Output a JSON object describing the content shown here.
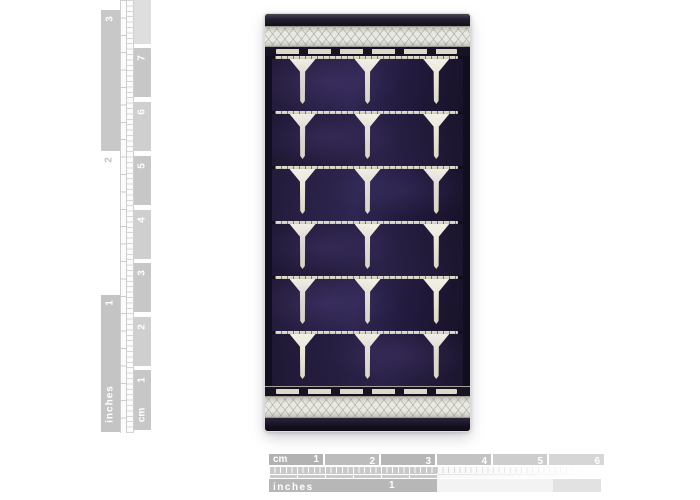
{
  "rulers": {
    "vertical": {
      "inches": {
        "label": "inches",
        "marks": [
          "3",
          "2",
          "1"
        ]
      },
      "cm": {
        "label": "cm",
        "marks": [
          "7",
          "6",
          "5",
          "4",
          "3",
          "2",
          "1"
        ]
      }
    },
    "horizontal": {
      "cm": {
        "label": "cm",
        "marks": [
          "1",
          "2",
          "3",
          "4",
          "5",
          "6"
        ]
      },
      "inches": {
        "label": "inches",
        "marks": [
          "1"
        ]
      }
    }
  },
  "panel": {
    "cell_rows": 6,
    "electrodes_per_row": 3,
    "colors": {
      "cell_purple": "#2a2148",
      "cell_shadow": "#16101f",
      "electrode_silver": "#ece7da",
      "foil_band": "#e9e9e3",
      "edge_black": "#1a1426",
      "ruler_gray": "#b7b7b7"
    }
  }
}
